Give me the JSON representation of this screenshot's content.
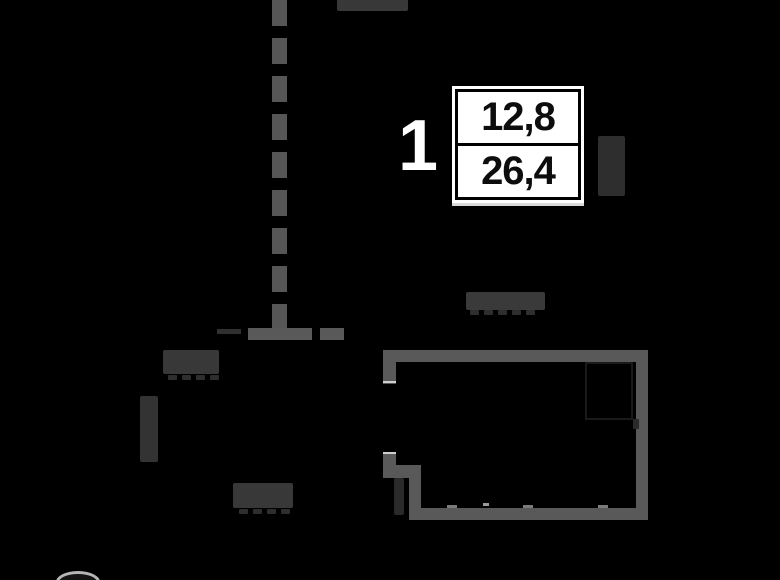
{
  "image": {
    "kind": "apartment-floor-plan",
    "background_color": "#000000"
  },
  "unit": {
    "number_label": "1",
    "area_top": "12,8",
    "area_bottom": "26,4"
  },
  "colors": {
    "wall": "#595959",
    "dashed_axis": "#565656",
    "dim_label_block": "#383838",
    "info_box_background": "#ffffff",
    "info_box_border": "#000000",
    "area_text": "#0d0d0d",
    "unit_number_text": "#ffffff"
  },
  "illegible_labels": {
    "note": "dimension labels are rendered too dark to read in the source image",
    "items": [
      "top-edge-dimension (cut off by image top)",
      "upper-left-dimension",
      "left-vertical-dimension",
      "lower-left-dimension",
      "center-dimension-above-room",
      "vertical-label-right-of-area-box",
      "small-vertical-label-at-door"
    ]
  }
}
